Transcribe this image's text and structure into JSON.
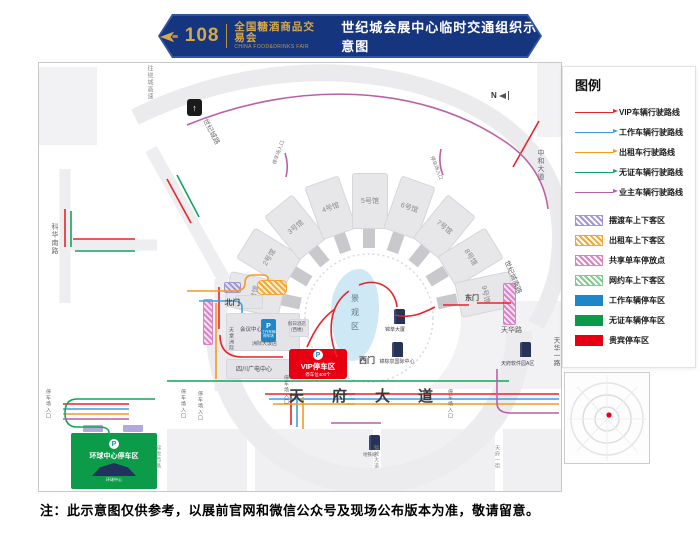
{
  "header": {
    "number": "108",
    "fair_cn": "全国糖酒商品交易会",
    "fair_en": "CHINA FOOD&DRINKS FAIR",
    "title": "世纪城会展中心临时交通组织示意图"
  },
  "legend": {
    "title": "图例",
    "routes": [
      {
        "label": "VIP车辆行驶路线",
        "color": "#e8232a"
      },
      {
        "label": "工作车辆行驶路线",
        "color": "#3aa0dc"
      },
      {
        "label": "出租车行驶路线",
        "color": "#f59a23"
      },
      {
        "label": "无证车辆行驶路线",
        "color": "#14a45c"
      },
      {
        "label": "业主车辆行驶路线",
        "color": "#bb5fa8"
      }
    ],
    "zones": [
      {
        "label": "摆渡车上下客区",
        "color": "#9f97d6",
        "style": "hatch"
      },
      {
        "label": "出租车上下客区",
        "color": "#f5a733",
        "style": "hatch"
      },
      {
        "label": "共享单车停放点",
        "color": "#d983c4",
        "style": "hatch"
      },
      {
        "label": "网约车上下客区",
        "color": "#7ecb8f",
        "style": "hatch"
      },
      {
        "label": "工作车辆停车区",
        "color": "#1f86c8",
        "style": "solid"
      },
      {
        "label": "无证车辆停车区",
        "color": "#0b9a48",
        "style": "solid"
      },
      {
        "label": "贵宾停车区",
        "color": "#e60012",
        "style": "solid"
      }
    ]
  },
  "map": {
    "compass": "N",
    "halls": [
      "1号馆",
      "2号馆",
      "3号馆",
      "4号馆",
      "5号馆",
      "6号馆",
      "7号馆",
      "8号馆",
      "9号馆"
    ],
    "garden": "景观区",
    "gates": {
      "north": "北门",
      "west": "西门",
      "east": "东门"
    },
    "roads": {
      "tianfu": "天府大道",
      "tianhua": "天华路",
      "tianhua_yi": "天华一路",
      "shiji_nan": "世纪城南路",
      "zhonghe": "中和大道",
      "shijicheng": "世纪城路",
      "kehua": "科华南路",
      "raocheng": "往绕城高速",
      "jinyue_xi": "锦悦西路",
      "jincheng": "锦城大道",
      "tianfu_yi": "天府一街"
    },
    "buildings": {
      "conference": "会议中心",
      "paradise": "天堂洲际",
      "intercontinental": "洲际大饭店",
      "holiday": "假日酒店",
      "holiday_sub": "(西楼)",
      "guangdian": "四川广电中心",
      "jincui": "锦萃大厦",
      "jinzongquan": "锦棕泉国际中心",
      "software": "天府软件园A区",
      "metro": "地铁站"
    },
    "vip": {
      "label": "VIP停车区",
      "sub": "停车位400个"
    },
    "work": {
      "l1": "工作车辆",
      "l2": "停车场"
    },
    "global": {
      "label": "环球中心停车区",
      "icon_label": "环球中心"
    },
    "entrance": "停车场入口",
    "p": "P",
    "up_arrow": "↑"
  },
  "note": "注：此示意图仅供参考，以展前官网和微信公众号及现场公布版本为准，敬请留意。"
}
